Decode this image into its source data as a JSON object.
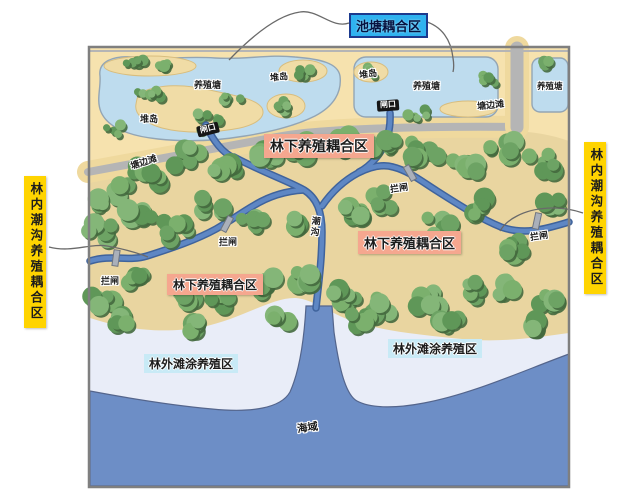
{
  "palette": {
    "page_bg": "#ffffff",
    "map_border": "#7f7f7f",
    "land_beige": "#f6e2ae",
    "road_shoulder": "#efd99e",
    "road_gray": "#b5b5b5",
    "pond_blue": "#bedcee",
    "pond_edge": "#93a5b4",
    "island_tan": "#f0dca6",
    "island_edge": "#d8bd7e",
    "forest_floor": "#e9d5a0",
    "channel_blue": "#5e87c4",
    "channel_edge": "#3f639c",
    "sea_blue": "#6d8ec6",
    "flat_light": "#e9edf8",
    "tree_greens": [
      "#6da364",
      "#7bb06d",
      "#5f9758",
      "#84b678"
    ],
    "tree_dark": "#44693e",
    "leader_gray": "#6a6a6a",
    "gate_black": "#161616",
    "gate_gray": "#aab0ba",
    "label_ink": "#1c1c1c",
    "callout_blue_bg": "#2fb2ef",
    "callout_blue_border": "#1c3a8e",
    "callout_pink_bg": "#f5a78f",
    "callout_yellow_bg": "#ffd400",
    "callout_cyan_bg": "#c8eaf6"
  },
  "labels": {
    "pond_coupling_zone": "池塘耦合区",
    "under_forest_zone": "林下养殖耦合区",
    "inner_creek_zone": "林内潮沟养殖耦合区",
    "outer_flat_zone": "林外滩涂养殖区",
    "aquaculture_pond": "养殖塘",
    "pile_island": "堆岛",
    "sluice_gate": "闸口",
    "pond_side_flat": "塘边滩",
    "barrier_gate": "拦闸",
    "tidal_creek": "潮沟",
    "sea": "海域"
  }
}
